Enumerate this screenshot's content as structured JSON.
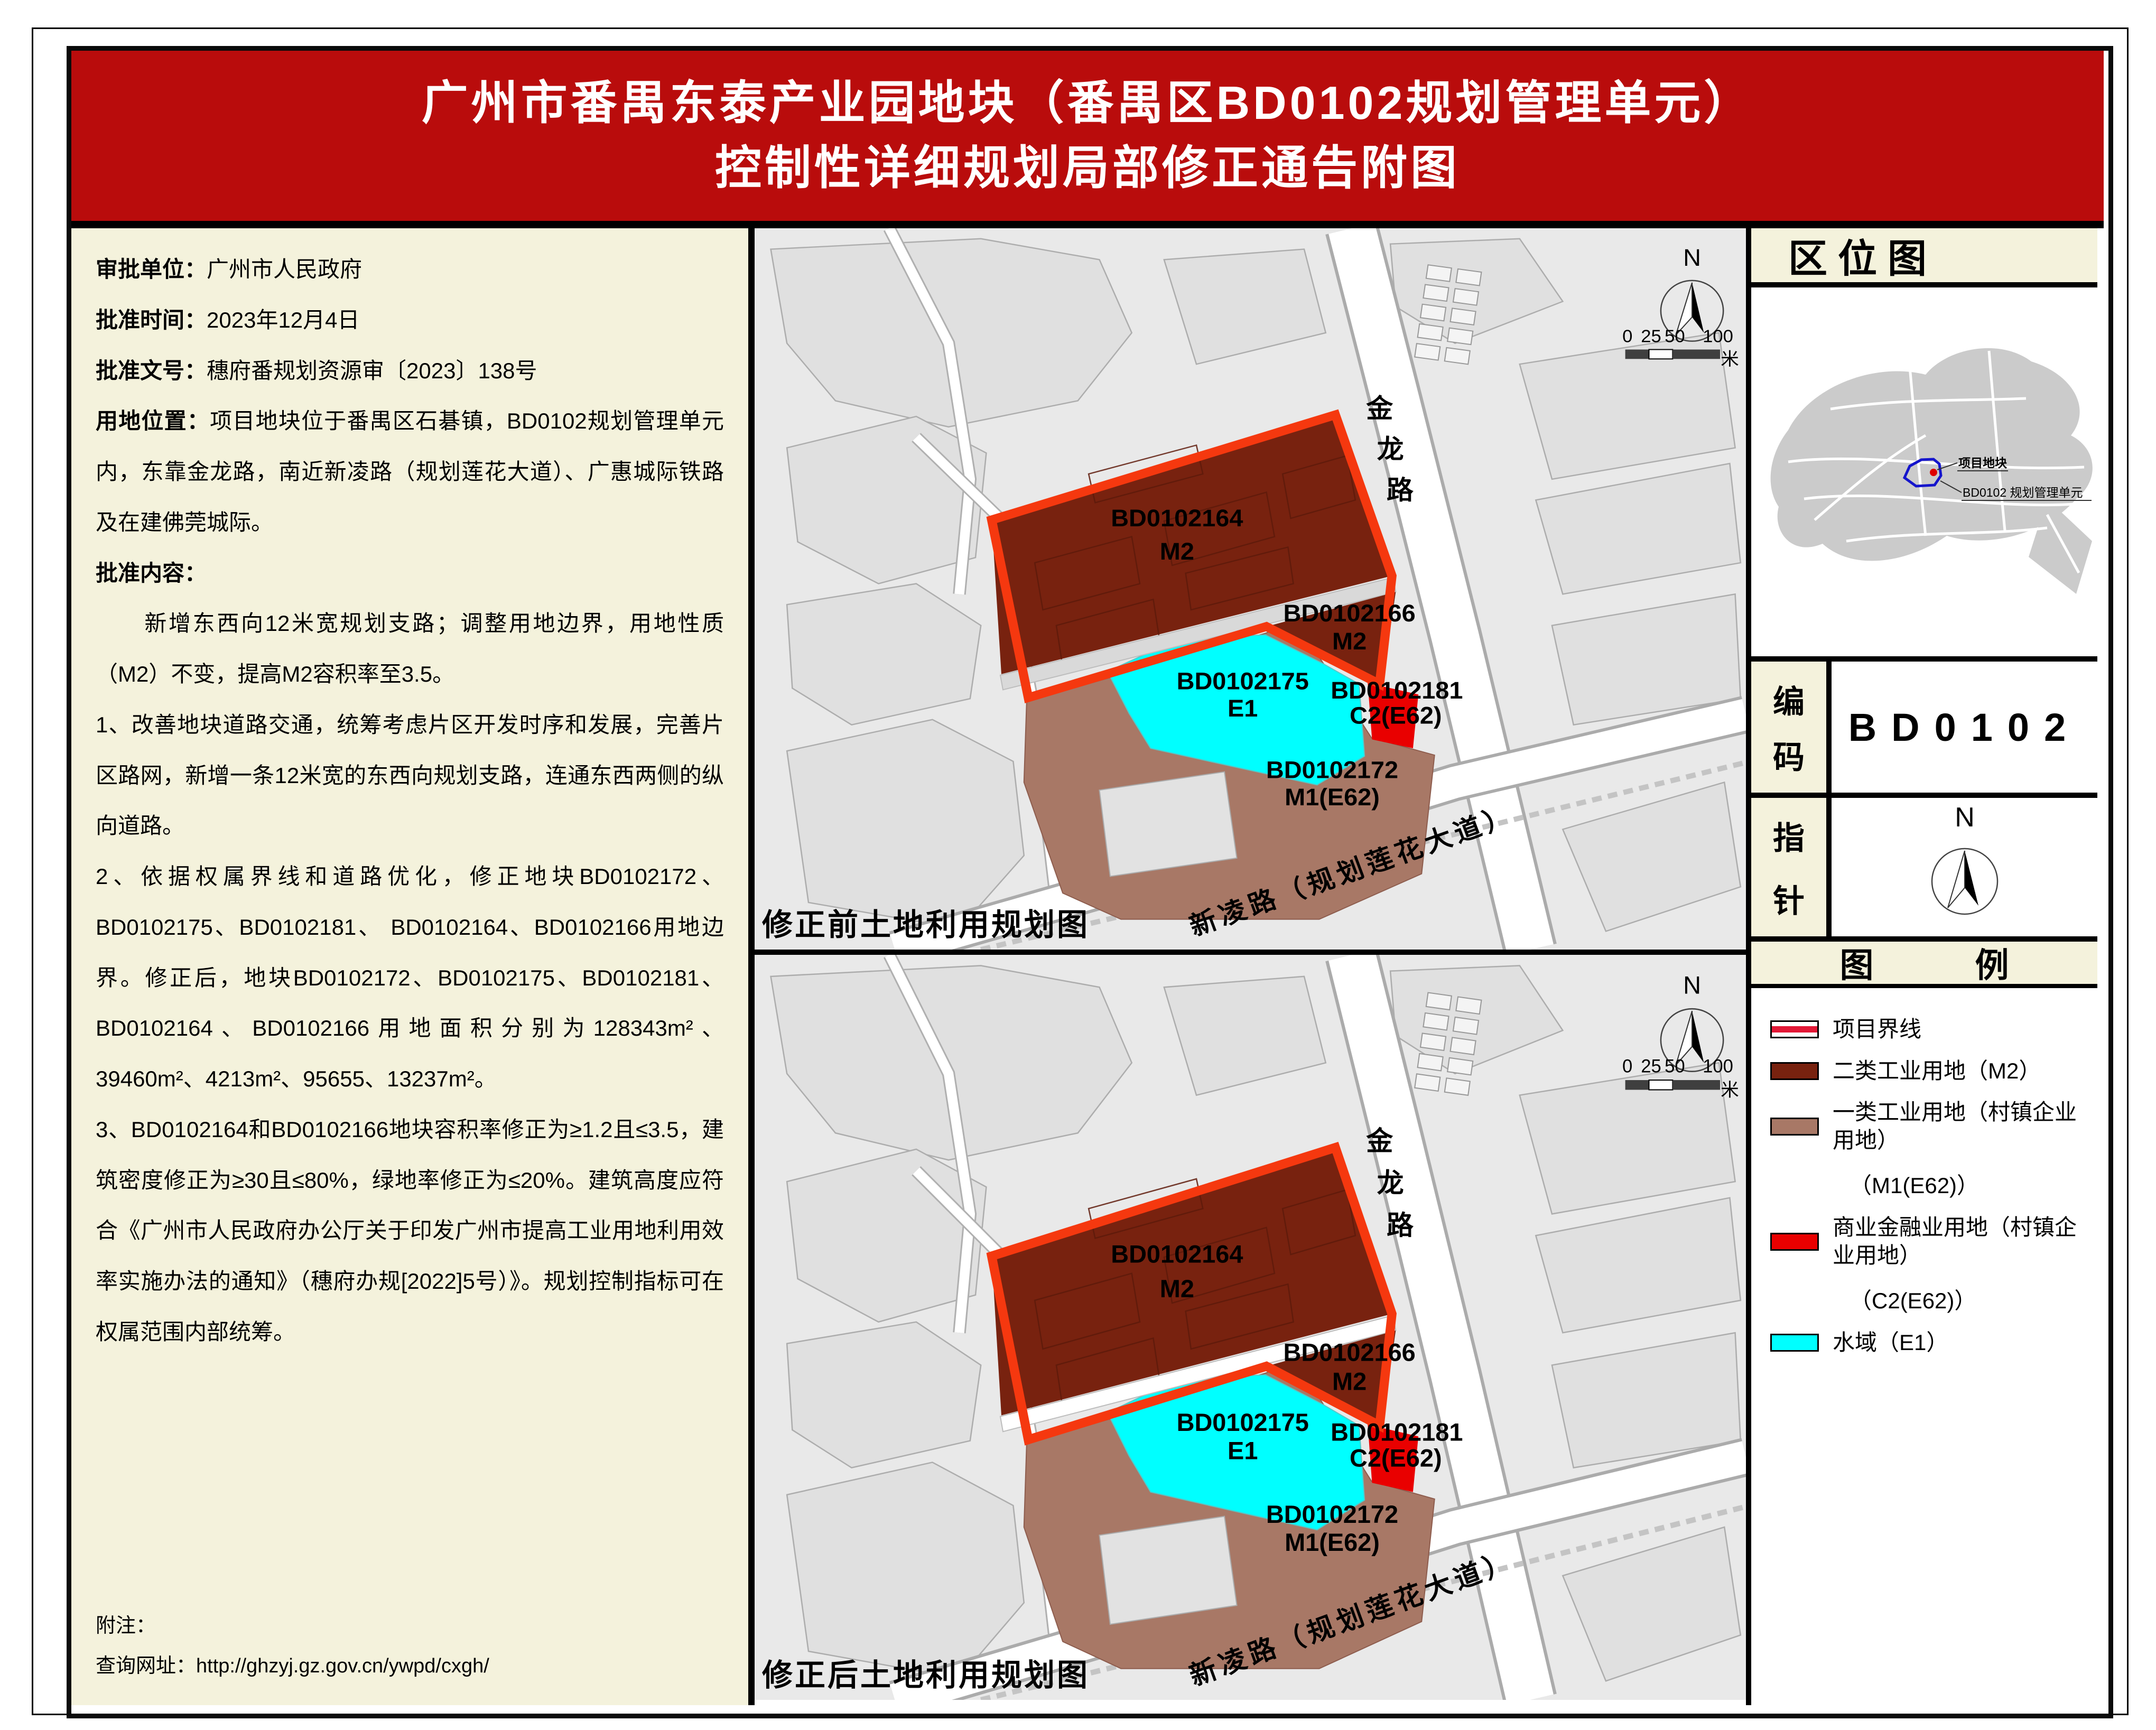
{
  "header": {
    "title_line1": "广州市番禺东泰产业园地块（番禺区BD0102规划管理单元）",
    "title_line2": "控制性详细规划局部修正通告附图"
  },
  "info": {
    "items": [
      {
        "label": "审批单位：",
        "text": "广州市人民政府"
      },
      {
        "label": "批准时间：",
        "text": "2023年12月4日"
      },
      {
        "label": "批准文号：",
        "text": "穗府番规划资源审〔2023〕138号"
      },
      {
        "label": "用地位置：",
        "text": "项目地块位于番禺区石碁镇，BD0102规划管理单元内，东靠金龙路，南近新凌路（规划莲花大道）、广惠城际铁路及在建佛莞城际。"
      },
      {
        "label": "批准内容：",
        "text": ""
      }
    ],
    "paragraphs": [
      "新增东西向12米宽规划支路；调整用地边界，用地性质（M2）不变，提高M2容积率至3.5。",
      "1、改善地块道路交通，统筹考虑片区开发时序和发展，完善片区路网，新增一条12米宽的东西向规划支路，连通东西两侧的纵向道路。",
      "2、依据权属界线和道路优化，修正地块BD0102172、BD0102175、BD0102181、 BD0102164、BD0102166用地边界。修正后，地块BD0102172、BD0102175、BD0102181、BD0102164、BD0102166用地面积分别为128343m²、39460m²、4213m²、95655、13237m²。",
      "3、BD0102164和BD0102166地块容积率修正为≥1.2且≤3.5，建筑密度修正为≥30且≤80%，绿地率修正为≤20%。建筑高度应符合《广州市人民政府办公厅关于印发广州市提高工业用地利用效率实施办法的通知》（穗府办规[2022]5号）》。规划控制指标可在权属范围内部统筹。"
    ],
    "note_label": "附注：",
    "note_url": "查询网址：http://ghzyj.gz.gov.cn/ywpd/cxgh/"
  },
  "maps": {
    "before_caption": "修正前土地利用规划图",
    "after_caption": "修正后土地利用规划图",
    "parcels": [
      {
        "id": "BD0102164",
        "code": "M2"
      },
      {
        "id": "BD0102166",
        "code": "M2"
      },
      {
        "id": "BD0102175",
        "code": "E1"
      },
      {
        "id": "BD0102181",
        "code": "C2(E62)"
      },
      {
        "id": "BD0102172",
        "code": "M1(E62)"
      }
    ],
    "jinlong": [
      "金",
      "龙",
      "路"
    ],
    "xinling": "新凌路（规划莲花大道）",
    "north": "N",
    "scale": {
      "n0": "0",
      "n25": "25",
      "n50": "50",
      "n100": "100",
      "unit": "米"
    }
  },
  "right_panel": {
    "location": {
      "title": "区位图",
      "site_label": "项目地块",
      "unit_label": "BD0102 规划管理单元"
    },
    "code": {
      "chars": [
        "编",
        "码"
      ],
      "value": "BD0102"
    },
    "compass": {
      "chars": [
        "指",
        "针"
      ],
      "north": "N"
    },
    "legend": {
      "title": "图　　　例",
      "items": [
        {
          "name": "项目界线"
        },
        {
          "name": "二类工业用地（M2）"
        },
        {
          "name": "一类工业用地（村镇企业用地）",
          "name2": "（M1(E62)）"
        },
        {
          "name": "商业金融业用地（村镇企业用地）",
          "name2": "（C2(E62)）"
        },
        {
          "name": "水域（E1）"
        }
      ]
    }
  },
  "colors": {
    "header_red": "#B90C0C",
    "panel_cream": "#F4F2DC",
    "boundary_red": "#F5380F",
    "m2_maroon": "#78220F",
    "m1_brown": "#A87866",
    "c2_red": "#E90000",
    "water_cyan": "#00FFFF",
    "map_bg": "#E9E9E9"
  }
}
